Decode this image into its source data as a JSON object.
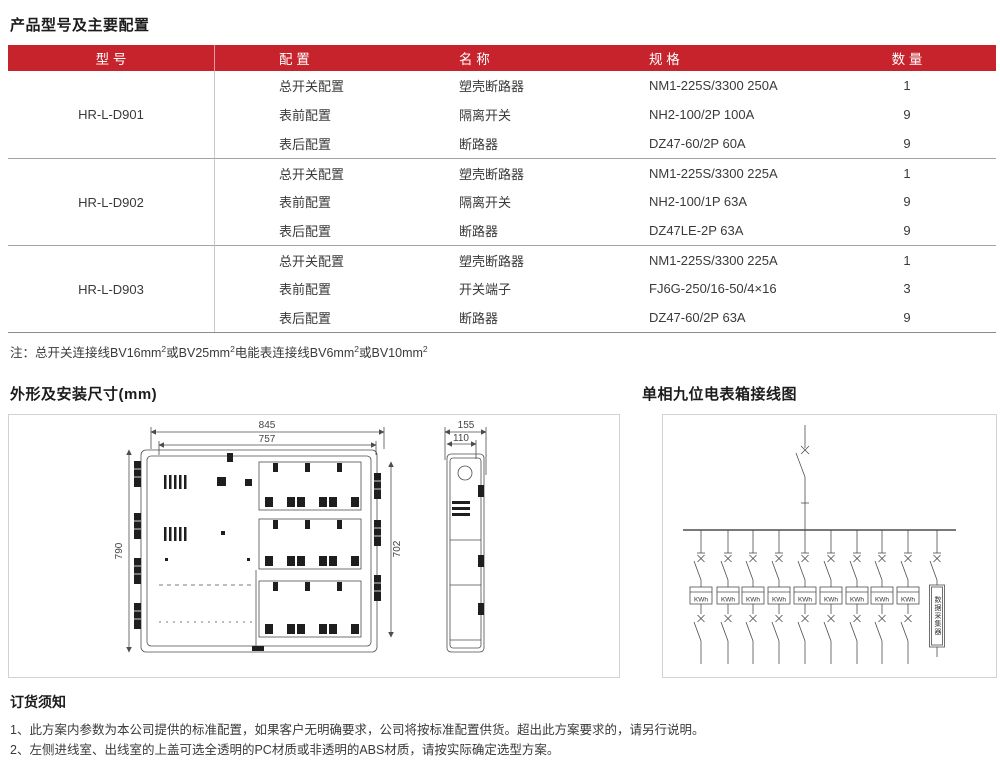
{
  "colors": {
    "header_red": "#C6232C"
  },
  "config_table": {
    "title": "产品型号及主要配置",
    "headers": {
      "model": "型 号",
      "config": "配 置",
      "name": "名 称",
      "spec": "规 格",
      "qty": "数 量"
    },
    "groups": [
      {
        "model": "HR-L-D901",
        "rows": [
          {
            "config": "总开关配置",
            "name": "塑壳断路器",
            "spec": "NM1-225S/3300  250A",
            "qty": "1"
          },
          {
            "config": "表前配置",
            "name": "隔离开关",
            "spec": "NH2-100/2P  100A",
            "qty": "9"
          },
          {
            "config": "表后配置",
            "name": "断路器",
            "spec": "DZ47-60/2P  60A",
            "qty": "9"
          }
        ]
      },
      {
        "model": "HR-L-D902",
        "rows": [
          {
            "config": "总开关配置",
            "name": "塑壳断路器",
            "spec": "NM1-225S/3300  225A",
            "qty": "1"
          },
          {
            "config": "表前配置",
            "name": "隔离开关",
            "spec": "NH2-100/1P  63A",
            "qty": "9"
          },
          {
            "config": "表后配置",
            "name": "断路器",
            "spec": "DZ47LE-2P  63A",
            "qty": "9"
          }
        ]
      },
      {
        "model": "HR-L-D903",
        "rows": [
          {
            "config": "总开关配置",
            "name": "塑壳断路器",
            "spec": "NM1-225S/3300  225A",
            "qty": "1"
          },
          {
            "config": "表前配置",
            "name": "开关端子",
            "spec": "FJ6G-250/16-50/4×16",
            "qty": "3"
          },
          {
            "config": "表后配置",
            "name": "断路器",
            "spec": "DZ47-60/2P  63A",
            "qty": "9"
          }
        ]
      }
    ],
    "note": {
      "label": "注：",
      "parts": [
        "总开关连接线BV16mm",
        "或BV25mm",
        "电能表连接线BV6mm",
        "或BV10mm"
      ],
      "sup": "2"
    }
  },
  "dimensions": {
    "section_title": "外形及安装尺寸(mm)",
    "front": {
      "outer_width": "845",
      "inner_width": "757",
      "height": "790",
      "inner_height": "702"
    },
    "side": {
      "depth": "155",
      "inner_depth": "110"
    }
  },
  "wiring": {
    "section_title": "单相九位电表箱接线图",
    "meter_label": "KWh",
    "meter_count": 9,
    "collector_label": "数据采集器"
  },
  "ordering": {
    "title": "订货须知",
    "items": [
      "1、此方案内参数为本公司提供的标准配置，如果客户无明确要求，公司将按标准配置供货。超出此方案要求的，请另行说明。",
      "2、左侧进线室、出线室的上盖可选全透明的PC材质或非透明的ABS材质，请按实际确定选型方案。"
    ]
  }
}
